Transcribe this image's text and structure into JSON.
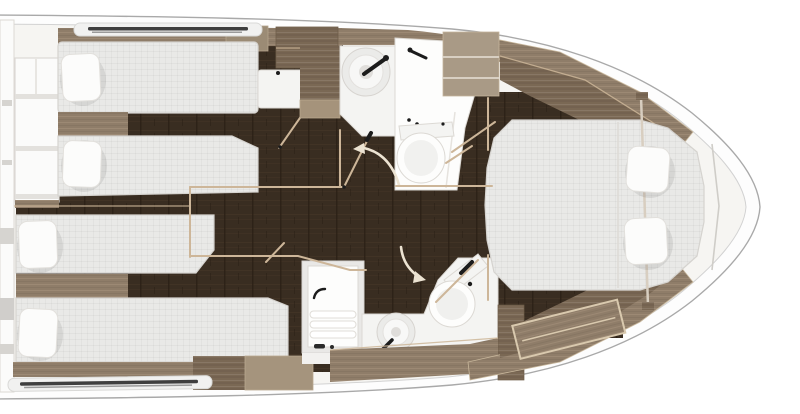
{
  "colors": {
    "hull_line": "#a9a9a9",
    "hull_inner_line": "#d2d2d2",
    "hull_fill": "#fdfdfd",
    "deck": "#f6f5f2",
    "floor_dark": "#392d21",
    "floor_seam": "#2a1f15",
    "floor_grain": "#4a3a2a",
    "wood_light": "#8f7d69",
    "wood_light_hi": "#a7947d",
    "wood_mid": "#7a6854",
    "wood_trim": "#cdb699",
    "mattress": "#e9e9e7",
    "mattress_line": "#d5d3cf",
    "pillow": "#fcfcfb",
    "fixture": "#f4f4f2",
    "fixture_stroke": "#dcd9d4",
    "white_bright": "#fdfdfc",
    "accent_black": "#1c1c1c",
    "door_arc": "#ece3d2",
    "window_dark": "#3f3f3f",
    "gray_mark": "#d6d4d0",
    "stair_white": "#fbfbfa"
  },
  "diagram": {
    "type": "yacht-interior-floor-plan",
    "orientation": "bow-right",
    "rooms": [
      {
        "id": "companionway",
        "feature": "stairs"
      },
      {
        "id": "guest-cabin-top",
        "beds": 2,
        "pillows": 2,
        "features": [
          "hull-window",
          "desk",
          "cabinets",
          "door"
        ]
      },
      {
        "id": "guest-cabin-bottom",
        "beds": 2,
        "pillows": 2,
        "features": [
          "hull-window",
          "sideboard",
          "door"
        ]
      },
      {
        "id": "bathroom-top",
        "fixtures": [
          "vessel-sink",
          "faucet",
          "shower",
          "toilet",
          "door-swing"
        ]
      },
      {
        "id": "bathroom-bottom",
        "fixtures": [
          "shower-bench",
          "vessel-sink",
          "faucet",
          "toilet",
          "door-swing"
        ]
      },
      {
        "id": "master-cabin",
        "beds": 1,
        "pillows": 2,
        "features": [
          "hull-cabinetry",
          "entry-steps",
          "stanchion"
        ]
      }
    ]
  }
}
